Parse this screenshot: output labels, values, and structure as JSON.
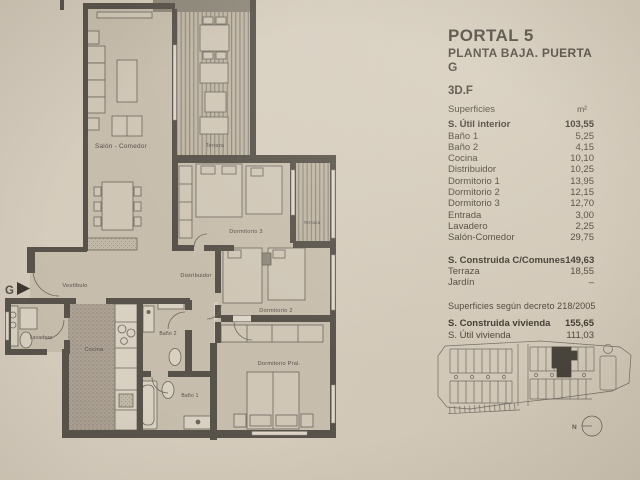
{
  "panel": {
    "title": "PORTAL 5",
    "subtitle": "PLANTA BAJA. PUERTA G",
    "unit_code": "3D.F",
    "header": {
      "label": "Superficies",
      "unit": "m²"
    },
    "interior_rows": [
      {
        "label": "S. Útil interior",
        "value": "103,55"
      },
      {
        "label": "Baño 1",
        "value": "5,25"
      },
      {
        "label": "Baño 2",
        "value": "4,15"
      },
      {
        "label": "Cocina",
        "value": "10,10"
      },
      {
        "label": "Distribuidor",
        "value": "10,25"
      },
      {
        "label": "Dormitorio 1",
        "value": "13,95"
      },
      {
        "label": "Dormitorio 2",
        "value": "12,15"
      },
      {
        "label": "Dormitorio 3",
        "value": "12,70"
      },
      {
        "label": "Entrada",
        "value": "3,00"
      },
      {
        "label": "Lavadero",
        "value": "2,25"
      },
      {
        "label": "Salón-Comedor",
        "value": "29,75"
      }
    ],
    "constructed_rows": [
      {
        "label": "S. Construida C/Comunes",
        "value": "149,63"
      },
      {
        "label": "Terraza",
        "value": "18,55"
      },
      {
        "label": "Jardín",
        "value": "–"
      }
    ],
    "decree_note": "Superficies según decreto 218/2005",
    "dwelling_rows": [
      {
        "label": "S. Construida vivienda",
        "value": "155,65"
      },
      {
        "label": "S. Útil vivienda",
        "value": "111,03"
      }
    ]
  },
  "plan": {
    "labels": {
      "salon": "Salón - Comedor",
      "terraza_top": "Terraza",
      "terraza_right": "Terraza",
      "dorm3": "Dormitorio 3",
      "distribuidor": "Distribuidor",
      "dorm2": "Dormitorio 2",
      "dorm_pral": "Dormitorio Pral.",
      "bano1": "Baño 1",
      "bano2": "Baño 2",
      "cocina": "Cocina",
      "lavadero": "Lavadero",
      "vestibulo": "Vestíbulo",
      "entrance": "G"
    }
  },
  "siteplan": {
    "north": "N"
  },
  "colors": {
    "paper": "#d3c9ba",
    "ink": "#4a4337",
    "wall": "#57524a",
    "highlight_unit": "#36332b"
  }
}
